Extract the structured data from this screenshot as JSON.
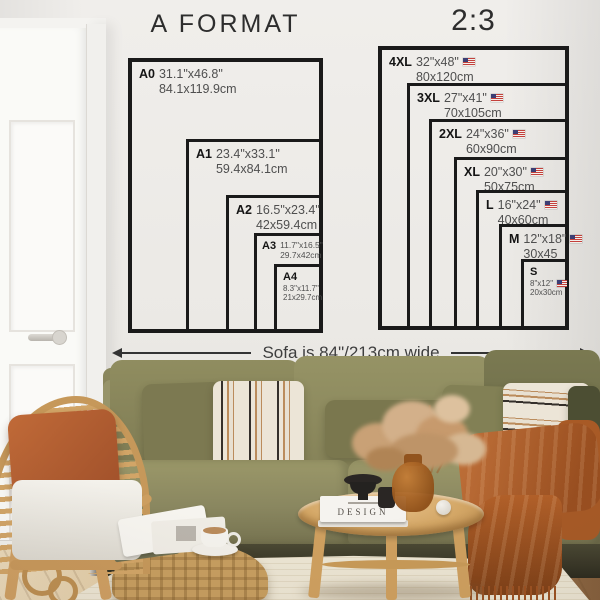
{
  "a_format": {
    "title": "A FORMAT",
    "sizes": [
      {
        "code": "A0",
        "inches": "31.1\"x46.8\"",
        "cm": "84.1x119.9cm"
      },
      {
        "code": "A1",
        "inches": "23.4\"x33.1\"",
        "cm": "59.4x84.1cm"
      },
      {
        "code": "A2",
        "inches": "16.5\"x23.4\"",
        "cm": "42x59.4cm"
      },
      {
        "code": "A3",
        "inches": "11.7\"x16.5\"",
        "cm": "29.7x42cm"
      },
      {
        "code": "A4",
        "inches": "8.3\"x11.7\"",
        "cm": "21x29.7cm"
      }
    ]
  },
  "ratio_2_3": {
    "title": "2:3",
    "flag_icon": "us-flag-icon",
    "sizes": [
      {
        "code": "4XL",
        "inches": "32\"x48\"",
        "cm": "80x120cm"
      },
      {
        "code": "3XL",
        "inches": "27\"x41\"",
        "cm": "70x105cm"
      },
      {
        "code": "2XL",
        "inches": "24\"x36\"",
        "cm": "60x90cm"
      },
      {
        "code": "XL",
        "inches": "20\"x30\"",
        "cm": "50x75cm"
      },
      {
        "code": "L",
        "inches": "16\"x24\"",
        "cm": "40x60cm"
      },
      {
        "code": "M",
        "inches": "12\"x18\"",
        "cm": "30x45"
      },
      {
        "code": "S",
        "inches": "8\"x12\"",
        "cm": "20x30cm"
      }
    ]
  },
  "sofa_note": "Sofa is 84\"/213cm wide",
  "decor": {
    "book_title": "DESIGN"
  },
  "colors": {
    "chart_line": "#1a1a1a",
    "sofa_olive": "#87845c",
    "throw_rust": "#b5682f",
    "wood_rattan": "#d2a567",
    "wall": "#edebe8"
  }
}
